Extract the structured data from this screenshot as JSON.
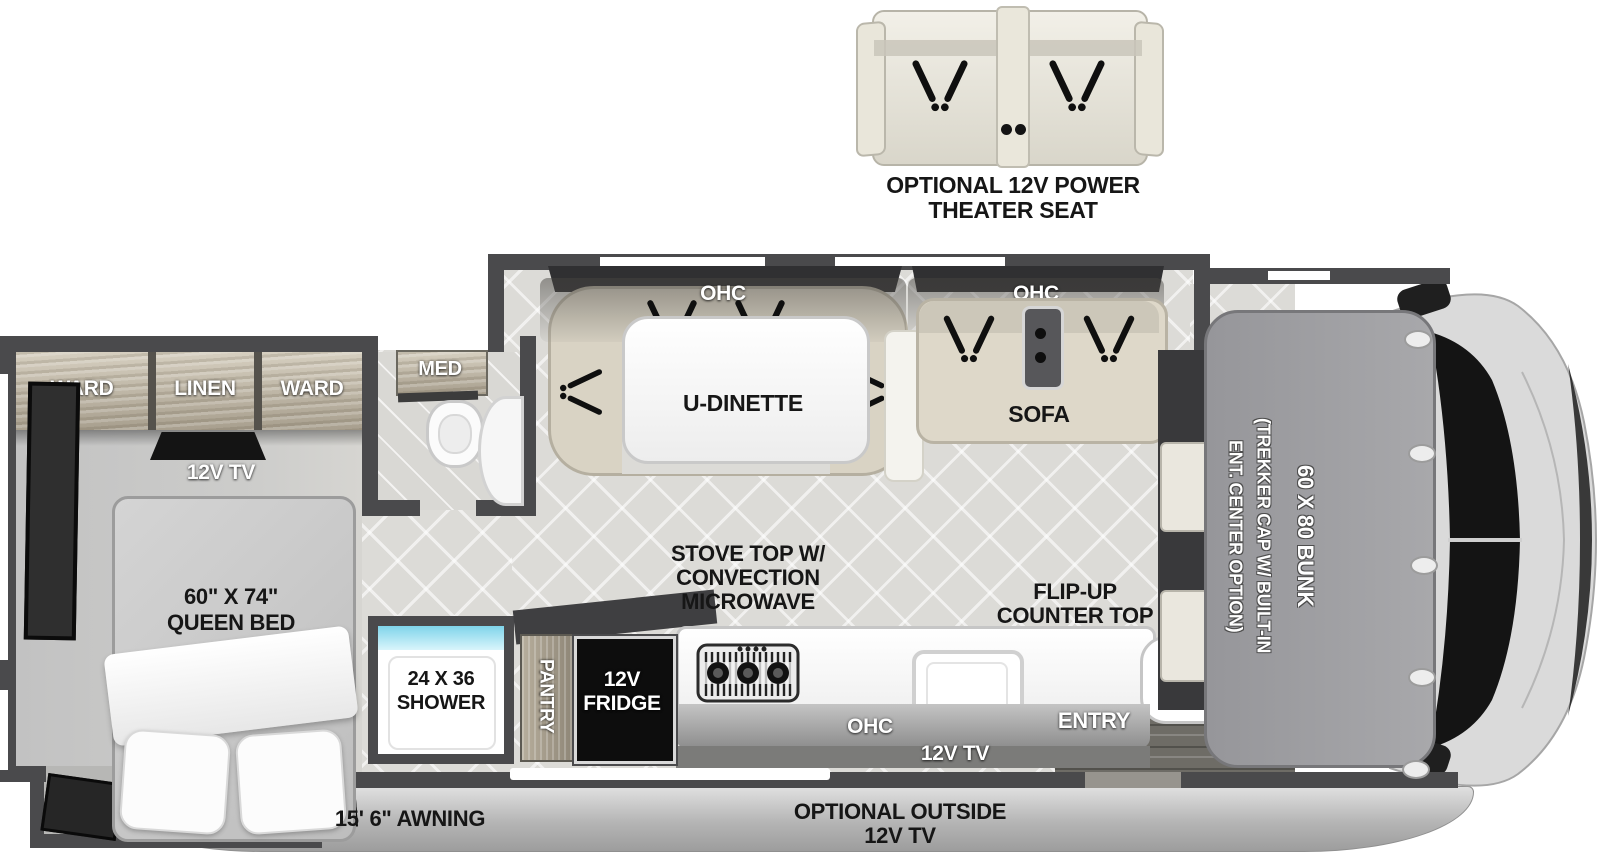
{
  "theater_seat": {
    "label1": "OPTIONAL 12V POWER",
    "label2": "THEATER SEAT"
  },
  "bedroom": {
    "ward_left": "WARD",
    "linen": "LINEN",
    "ward_right": "WARD",
    "tv": "12V TV",
    "bed1": "60\" X 74\"",
    "bed2": "QUEEN BED"
  },
  "bathroom": {
    "med": "MED"
  },
  "living": {
    "dinette_ohc": "OHC",
    "dinette": "U-DINETTE",
    "sofa_ohc": "OHC",
    "sofa": "SOFA"
  },
  "kitchen": {
    "stove1": "STOVE TOP W/",
    "stove2": "CONVECTION",
    "stove3": "MICROWAVE",
    "flip1": "FLIP-UP",
    "flip2": "COUNTER TOP",
    "ohc": "OHC",
    "tv": "12V TV",
    "pantry": "PANTRY",
    "fridge1": "12V",
    "fridge2": "FRIDGE"
  },
  "shower": {
    "line1": "24 X 36",
    "line2": "SHOWER"
  },
  "entry": {
    "label": "ENTRY"
  },
  "bunk": {
    "option1": "(TREKKER CAP W/ BUILT-IN",
    "option2": "ENT. CENTER OPTION)",
    "label": "60 X 80 BUNK"
  },
  "exterior": {
    "awning": "15' 6\" AWNING",
    "outside_tv1": "OPTIONAL OUTSIDE",
    "outside_tv2": "12V TV"
  },
  "colors": {
    "wall": "#4a4a4c",
    "floor": "#dcdbd7",
    "cabinet_wood": "#b9b09e",
    "shower_accent": "#8edcee",
    "fridge": "#0d0d0d",
    "counter": "#ffffff"
  }
}
